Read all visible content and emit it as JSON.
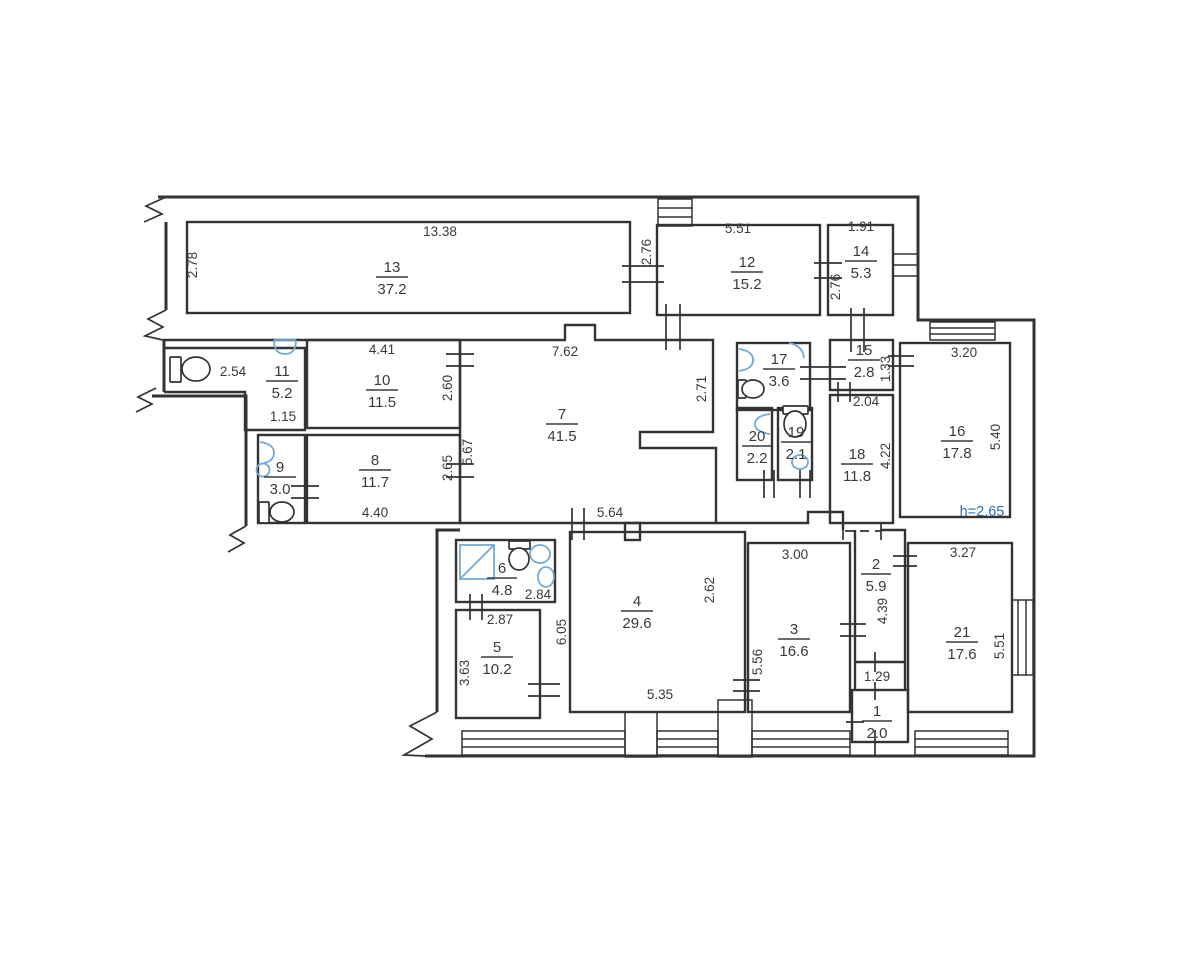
{
  "plan": {
    "type": "apartment-floor-plan",
    "colors": {
      "wall": "#333333",
      "fixture_blue": "#74a9d2",
      "note_blue": "#2e6fb8",
      "paper": "#ffffff"
    },
    "note": {
      "ceiling_height": "h=2.65"
    },
    "rooms": {
      "r1": {
        "number": "1",
        "area": "2.0"
      },
      "r2": {
        "number": "2",
        "area": "5.9"
      },
      "r3": {
        "number": "3",
        "area": "16.6"
      },
      "r4": {
        "number": "4",
        "area": "29.6"
      },
      "r5": {
        "number": "5",
        "area": "10.2"
      },
      "r6": {
        "number": "6",
        "area": "4.8"
      },
      "r7": {
        "number": "7",
        "area": "41.5"
      },
      "r8": {
        "number": "8",
        "area": "11.7"
      },
      "r9": {
        "number": "9",
        "area": "3.0"
      },
      "r10": {
        "number": "10",
        "area": "11.5"
      },
      "r11": {
        "number": "11",
        "area": "5.2"
      },
      "r12": {
        "number": "12",
        "area": "15.2"
      },
      "r13": {
        "number": "13",
        "area": "37.2"
      },
      "r14": {
        "number": "14",
        "area": "5.3"
      },
      "r15": {
        "number": "15",
        "area": "2.8"
      },
      "r16": {
        "number": "16",
        "area": "17.8"
      },
      "r17": {
        "number": "17",
        "area": "3.6"
      },
      "r18": {
        "number": "18",
        "area": "11.8"
      },
      "r19": {
        "number": "19",
        "area": "2.1"
      },
      "r20": {
        "number": "20",
        "area": "2.2"
      },
      "r21": {
        "number": "21",
        "area": "17.6"
      }
    },
    "dims": {
      "d13_w": "13.38",
      "d13_h": "2.78",
      "d12_w": "5.51",
      "d12_h": "2.76",
      "d14_w": "1.91",
      "d14_h": "2.76",
      "d11_a": "2.54",
      "d11_b": "1.15",
      "d10_w": "4.41",
      "d10_h": "2.60",
      "d7_w": "7.62",
      "d7_hr": "2.71",
      "d7_hl": "5.67",
      "d7_b": "5.64",
      "d8_w": "4.40",
      "d8_h": "2.65",
      "d15_h": "1.33",
      "d18_w": "2.04",
      "d18_h": "4.22",
      "d16_w": "3.20",
      "d16_h": "5.40",
      "d6_w": "2.84",
      "d5_w": "2.87",
      "d5_h": "3.63",
      "d4_hl": "6.05",
      "d4_w": "5.35",
      "d4_hr": "2.62",
      "d3_w": "3.00",
      "d3_h": "5.56",
      "d2_h": "4.39",
      "d1_w": "1.29",
      "d21_w": "3.27",
      "d21_h": "5.51"
    }
  }
}
